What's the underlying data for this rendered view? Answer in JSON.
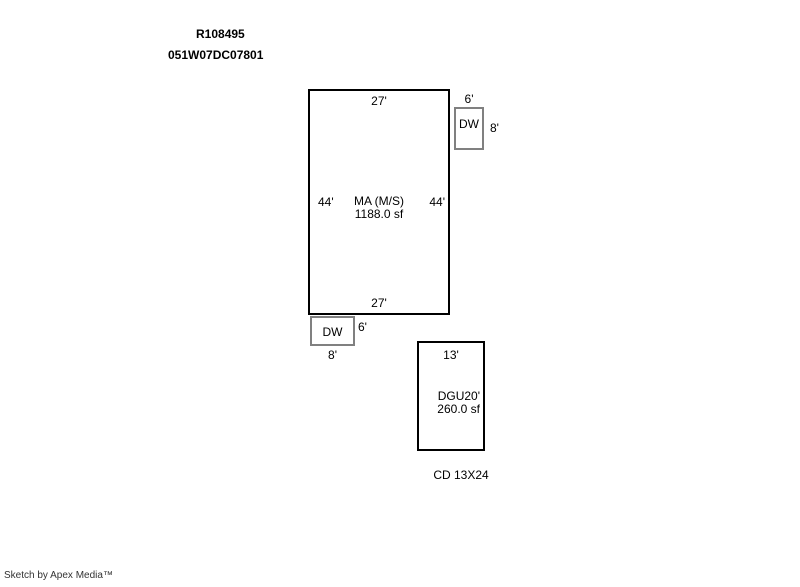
{
  "header": {
    "parcel_id": "R108495",
    "map_taxlot": "051W07DC07801"
  },
  "colors": {
    "structure_line": "#000000",
    "deck_line": "#808080",
    "text": "#000000"
  },
  "sketch": {
    "main_area": {
      "label": "MA (M/S)",
      "sqft": "1188.0 sf",
      "top_dim": "27'",
      "bottom_dim": "27'",
      "left_dim": "44'",
      "right_dim": "44'"
    },
    "deck_top_right": {
      "label": "DW",
      "top_dim": "6'",
      "right_dim": "8'"
    },
    "deck_bottom_left": {
      "label": "DW",
      "right_dim": "6'",
      "bottom_dim": "8'"
    },
    "garage": {
      "label": "DGU",
      "right_dim": "20'",
      "sqft": "260.0 sf",
      "top_dim": "13'",
      "caption": "CD 13X24"
    }
  },
  "footer": {
    "credit": "Sketch by Apex Media™"
  }
}
